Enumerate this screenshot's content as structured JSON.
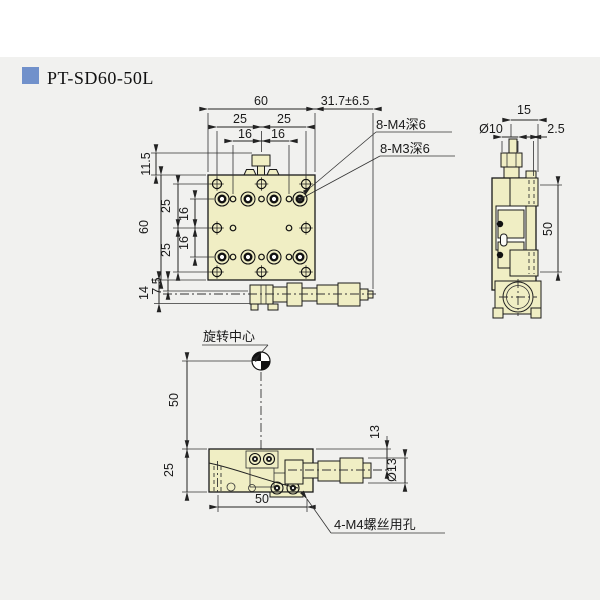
{
  "header": {
    "title": "PT-SD60-50L"
  },
  "colors": {
    "accent": "#7191cb",
    "part_fill": "#f0eec4",
    "background": "#f1f1ef",
    "top_band": "#ffffff",
    "line": "#1a1a1a"
  },
  "top_view": {
    "dim_width": "60",
    "dim_travel": "31.7±6.5",
    "dim_25_left": "25",
    "dim_25_right": "25",
    "dim_16_left": "16",
    "dim_16_right": "16",
    "dim_11_5": "11.5",
    "dim_v25_upper": "25",
    "dim_v16_upper": "16",
    "dim_v16_lower": "16",
    "dim_v25_lower": "25",
    "dim_height": "60",
    "dim_7_5": "7.5",
    "dim_14": "14",
    "label_m4": "8-M4深6",
    "label_m3": "8-M3深6"
  },
  "side_view": {
    "dim_15": "15",
    "dim_dia10": "Ø10",
    "dim_2_5": "2.5",
    "dim_50": "50"
  },
  "front_view": {
    "label_rotation_center": "旋转中心",
    "dim_50_vertical": "50",
    "dim_25": "25",
    "dim_13": "13",
    "dim_dia13": "Ø13",
    "dim_50_bottom": "50",
    "label_m4_holes": "4-M4螺丝用孔"
  }
}
